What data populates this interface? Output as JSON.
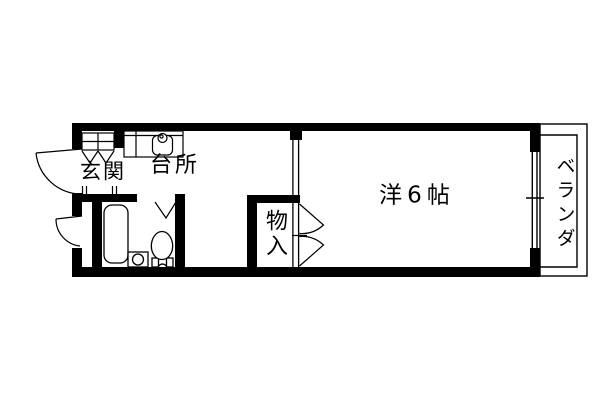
{
  "figure": {
    "kind": "apartment-floor-plan",
    "background_color": "#ffffff",
    "line_color": "#000000"
  },
  "rooms": {
    "genkan": {
      "label": "玄関"
    },
    "kitchen": {
      "label": "台所"
    },
    "closet": {
      "label": "物入"
    },
    "western_room": {
      "label": "洋6帖",
      "tatami": 6
    },
    "veranda": {
      "label": "ベランダ"
    },
    "bathroom": {
      "fixtures": [
        "bathtub",
        "wash-basin",
        "toilet",
        "folding-door"
      ]
    }
  }
}
